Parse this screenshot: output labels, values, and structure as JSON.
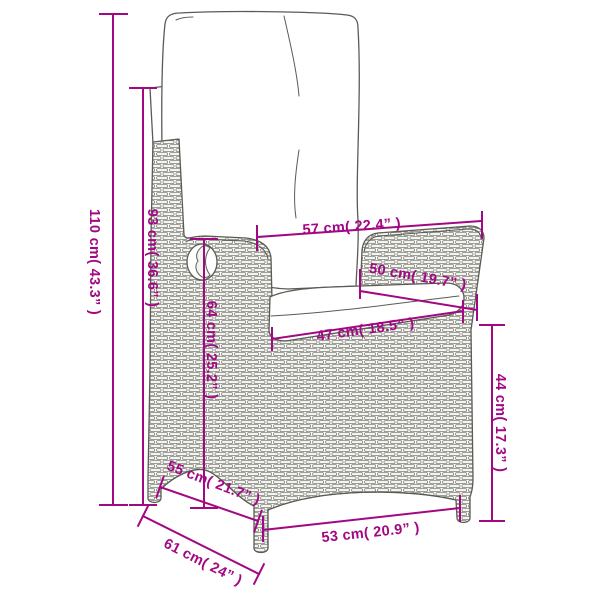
{
  "diagram": {
    "subject": "reclining-wicker-garden-chair-with-cushions",
    "accent_color": "#a30884",
    "line_color": "#5b5b55",
    "dimensions": {
      "total_height": "110 cm( 43.3” )",
      "backrest_height": "93 cm( 36.6” )",
      "inner_back_height": "64 cm( 25.2” )",
      "top_width": "57 cm( 22.4” )",
      "armrest_depth": "50 cm( 19.7” )",
      "seat_width": "47 cm( 18.5” )",
      "seat_height": "44 cm( 17.3” )",
      "seat_depth": "55 cm( 21.7” )",
      "base_depth": "61 cm( 24” )",
      "front_width": "53 cm( 20.9” )"
    }
  }
}
